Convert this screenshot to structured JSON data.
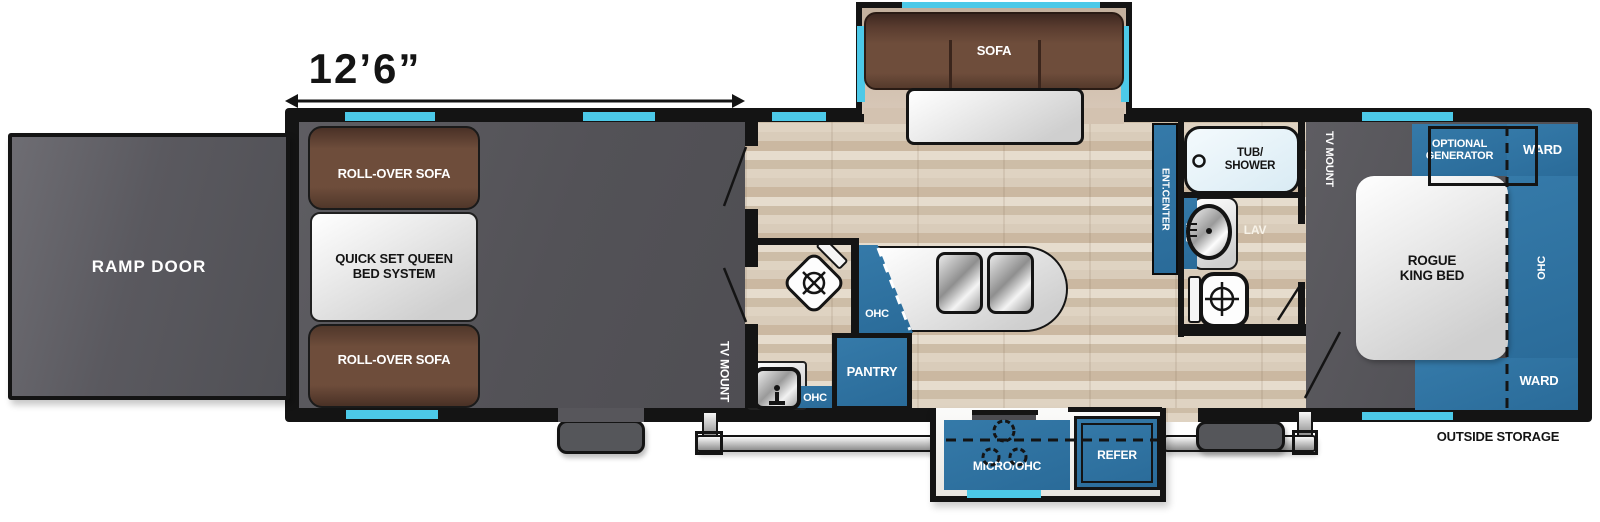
{
  "dimension": {
    "garage_length": "12’6”"
  },
  "exterior": {
    "ramp_door": "RAMP DOOR",
    "outside_storage": "OUTSIDE STORAGE"
  },
  "garage": {
    "roll_over_sofa_top": "ROLL-OVER SOFA",
    "queen_bed": "QUICK SET QUEEN\nBED SYSTEM",
    "roll_over_sofa_bottom": "ROLL-OVER SOFA",
    "tv_mount": "TV MOUNT"
  },
  "half_bath": {
    "ohc": "OHC"
  },
  "kitchen": {
    "island_ohc": "OHC",
    "pantry": "PANTRY",
    "micro_ohc": "MICRO/OHC",
    "refer": "REFER"
  },
  "living": {
    "sofa": "SOFA",
    "ent_center": "ENT.CENTER"
  },
  "bath": {
    "tub_shower": "TUB/\nSHOWER",
    "med": "MED",
    "lav": "LAV"
  },
  "bedroom": {
    "tv_mount": "TV MOUNT",
    "optional_generator": "OPTIONAL\nGENERATOR",
    "ward_top": "WARD",
    "ohc": "OHC",
    "bed": "ROGUE\nKING BED",
    "ward_bottom": "WARD"
  },
  "colors": {
    "cabinet_blue": "#2e72a2",
    "window_cyan": "#4cc9e8",
    "dark_floor": "#58575c",
    "wood_floor": "#d7c9b6",
    "sofa_brown": "#6b4a39",
    "wall_black": "#141414",
    "tub_blue": "#e2f0f6"
  }
}
